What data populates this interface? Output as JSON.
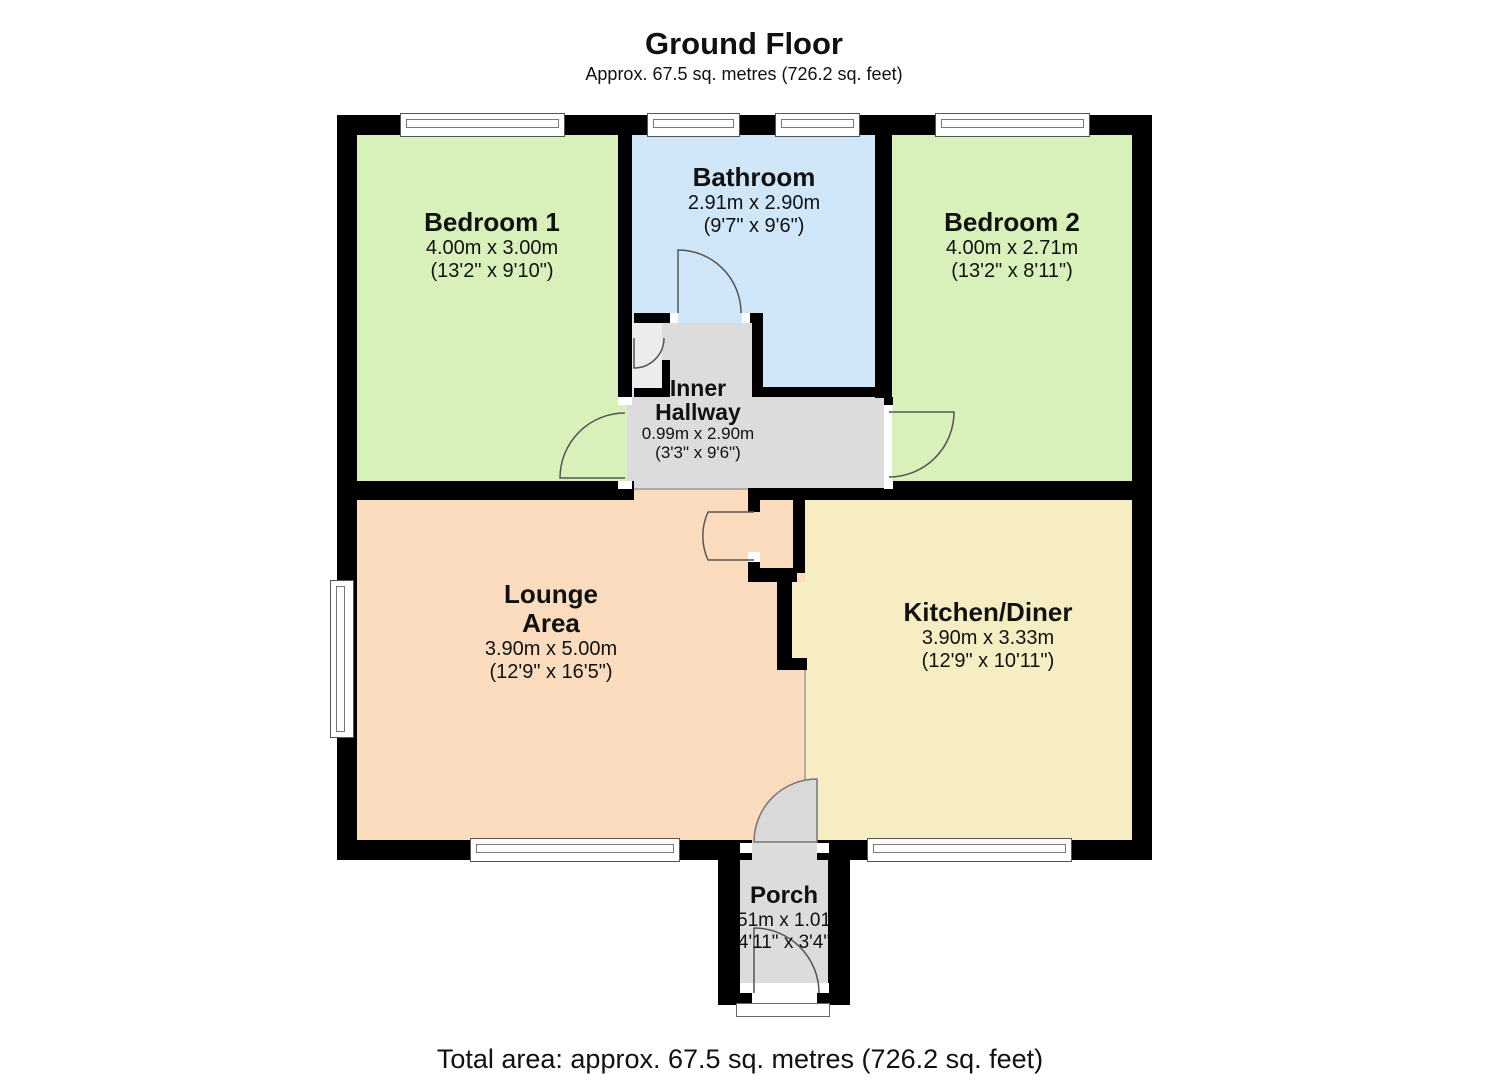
{
  "header": {
    "title": "Ground Floor",
    "subtitle": "Approx. 67.5 sq. metres (726.2 sq. feet)"
  },
  "footer": {
    "total": "Total area: approx. 67.5 sq. metres (726.2 sq. feet)"
  },
  "rooms": {
    "bedroom1": {
      "name": "Bedroom 1",
      "metric": "4.00m x 3.00m",
      "imperial": "(13'2\" x 9'10\")"
    },
    "bathroom": {
      "name": "Bathroom",
      "metric": "2.91m x 2.90m",
      "imperial": "(9'7\" x 9'6\")"
    },
    "bedroom2": {
      "name": "Bedroom 2",
      "metric": "4.00m x 2.71m",
      "imperial": "(13'2\" x 8'11\")"
    },
    "hallway": {
      "name": "Inner Hallway",
      "metric": "0.99m x 2.90m",
      "imperial": "(3'3\" x 9'6\")"
    },
    "lounge": {
      "name": "Lounge Area",
      "metric": "3.90m x 5.00m",
      "imperial": "(12'9\" x 16'5\")"
    },
    "kitchen": {
      "name": "Kitchen/Diner",
      "metric": "3.90m x 3.33m",
      "imperial": "(12'9\" x 10'11\")"
    },
    "porch": {
      "name": "Porch",
      "metric": "1.51m x 1.01m",
      "imperial": "(4'11\" x 3'4\")"
    }
  },
  "colors": {
    "wall": "#000000",
    "bedroom": "#d8f0ba",
    "bathroom": "#d0e7f9",
    "hallway": "#dcdcdc",
    "lounge": "#fbdcbf",
    "kitchen": "#f7edc3",
    "porch": "#dcdcdc",
    "cupboard": "#ececec",
    "window": "#ffffff"
  }
}
